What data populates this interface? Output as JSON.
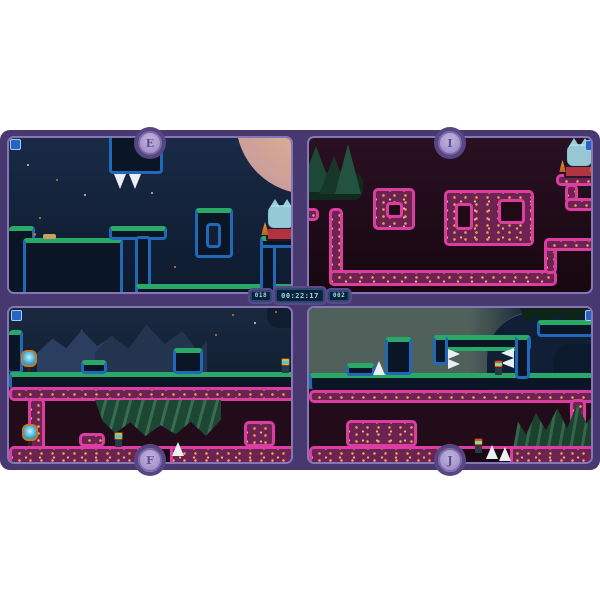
{
  "hud": {
    "timer": {
      "value": "00:22:17"
    },
    "left_counter": "018",
    "right_counter": "002"
  },
  "panels": [
    {
      "key": "E",
      "label": "E",
      "position": "top-left",
      "theme": "night-blue",
      "entities": [
        "moon",
        "stars",
        "hanging-spike-block",
        "ghost-cat",
        "bed",
        "traffic-cones",
        "ring-platform",
        "connection-indicator"
      ]
    },
    {
      "key": "I",
      "label": "I",
      "position": "top-right",
      "theme": "pink-tubes",
      "entities": [
        "pine-trees",
        "ghost-cat",
        "bed",
        "traffic-cones",
        "tube-maze",
        "connection-indicator"
      ]
    },
    {
      "key": "F",
      "label": "F",
      "position": "bottom-left",
      "theme": "dual-strip",
      "entities": [
        "mountains",
        "stars",
        "checkpoint-mirror",
        "players",
        "spike",
        "tube-floor",
        "hanging-forest",
        "connection-indicator"
      ]
    },
    {
      "key": "J",
      "label": "J",
      "position": "bottom-right",
      "theme": "dual-strip",
      "entities": [
        "mountain",
        "forest",
        "players",
        "spikes",
        "tube-floor",
        "connection-indicator"
      ]
    }
  ],
  "colors": {
    "page_background": "#ffffff",
    "frame_purple": "#483870",
    "panel_border": "#8577b6",
    "terrain_green": "#2aa868",
    "terrain_blue": "#2068b8",
    "tube_pink": "#dc3da0",
    "hud_text": "#9adcf0",
    "badge_fill": "#a898cc",
    "spike_white": "#e9eff3"
  }
}
